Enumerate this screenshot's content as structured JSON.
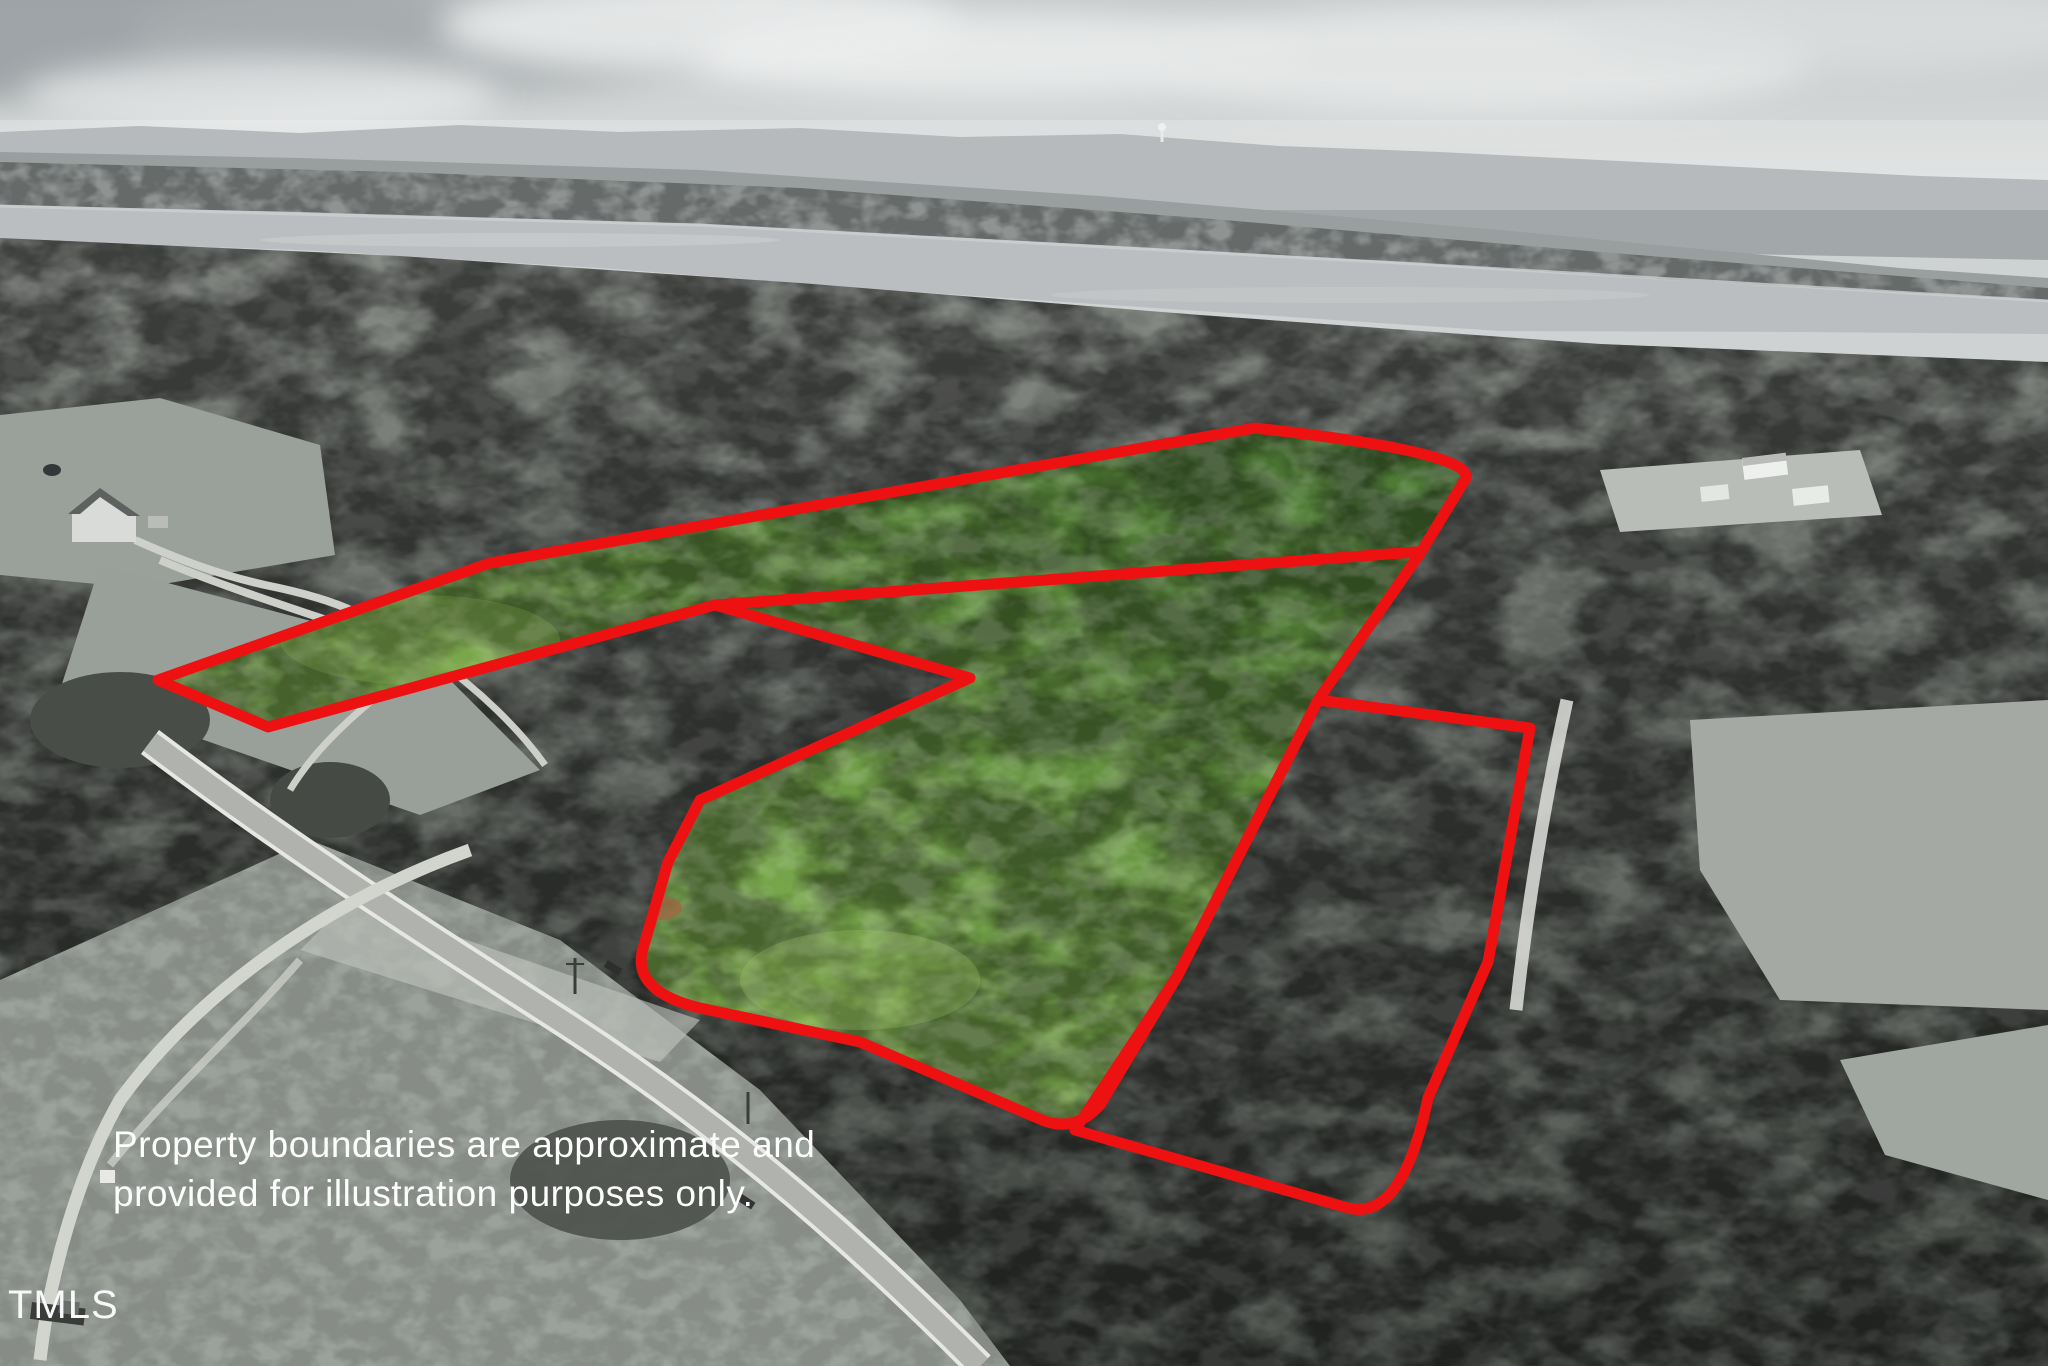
{
  "meta": {
    "kind": "aerial-property-listing-photo"
  },
  "disclaimer": {
    "line1": "Property boundaries are approximate and",
    "line2": "provided for illustration purposes only."
  },
  "watermark": {
    "text": "TMLS"
  },
  "boundary": {
    "color": "#ee1111",
    "stroke_width": 11,
    "main_path": "M158,680 L490,563 L1255,428 Q1472,452 1466,478 L1421,552 L1318,700 L1178,975 L1100,1105 Q1075,1133 1042,1120 L860,1042 L700,1008 Q634,992 642,952 L668,862 L700,800 L970,678 L715,605 L268,727 Z",
    "divider_path": "M715,605 L1415,552",
    "right_path": "M1318,700 L1530,728 L1488,962 L1428,1098 Q1402,1222 1348,1208 L1075,1130 L1178,975 Z"
  },
  "palette": {
    "sky": "#cfd2d2",
    "cloud_dark": "#9fa5a7",
    "cloud_light": "#e9ebeb",
    "ridge": "#a2a7a9",
    "far_forest": "#8f9493",
    "lake": "#babec0",
    "near_forest_dark": "#3f443f",
    "near_forest_light": "#7d817c",
    "field": "#9aa09a",
    "road": "#b0b2ae",
    "road_edge": "#e6e7e3",
    "highlight_green_bright": "#93bd5c",
    "highlight_green_deep": "#4a7634"
  }
}
